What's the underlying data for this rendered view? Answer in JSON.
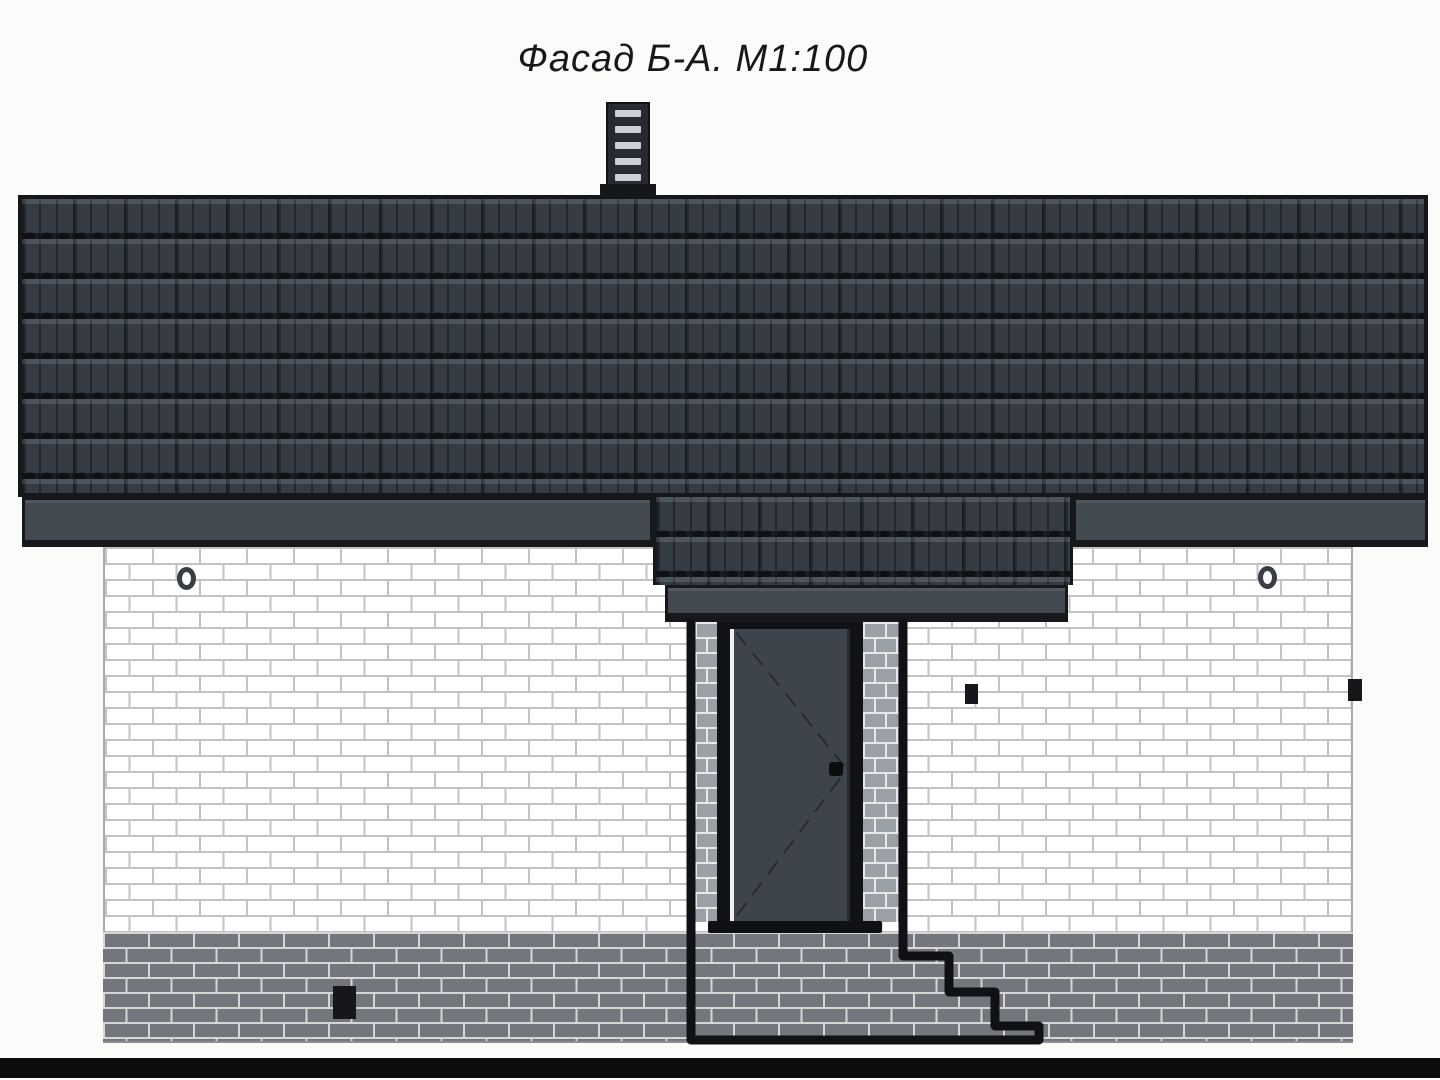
{
  "drawing": {
    "title": "Фасад Б-А. М1:100"
  },
  "features": {
    "chimney_slat_count": 5,
    "entry_step_count": 3,
    "round_vent_count": 2,
    "square_wall_vent_count": 2,
    "plinth_vent_count": 1
  },
  "colors": {
    "background": "#fbfbfa",
    "title_text": "#17181a",
    "roof_base": "#363c44",
    "fascia": "#424951",
    "outline": "#16181c",
    "wall_brick": "#ffffff",
    "wall_mortar": "#c2c2c2",
    "plinth_brick": "#73777d",
    "plinth_mortar": "#d6d6d6",
    "pillar_brick": "#9aa0a5",
    "pillar_mortar": "#e8e8e8",
    "door_panel": "#3d444c",
    "door_frame": "#101216",
    "door_highlight": "#eef0f1",
    "chimney_body": "#272a30",
    "chimney_slat": "#cdd0d4",
    "ground": "#0b0c0e",
    "vent_black": "#15171a"
  }
}
